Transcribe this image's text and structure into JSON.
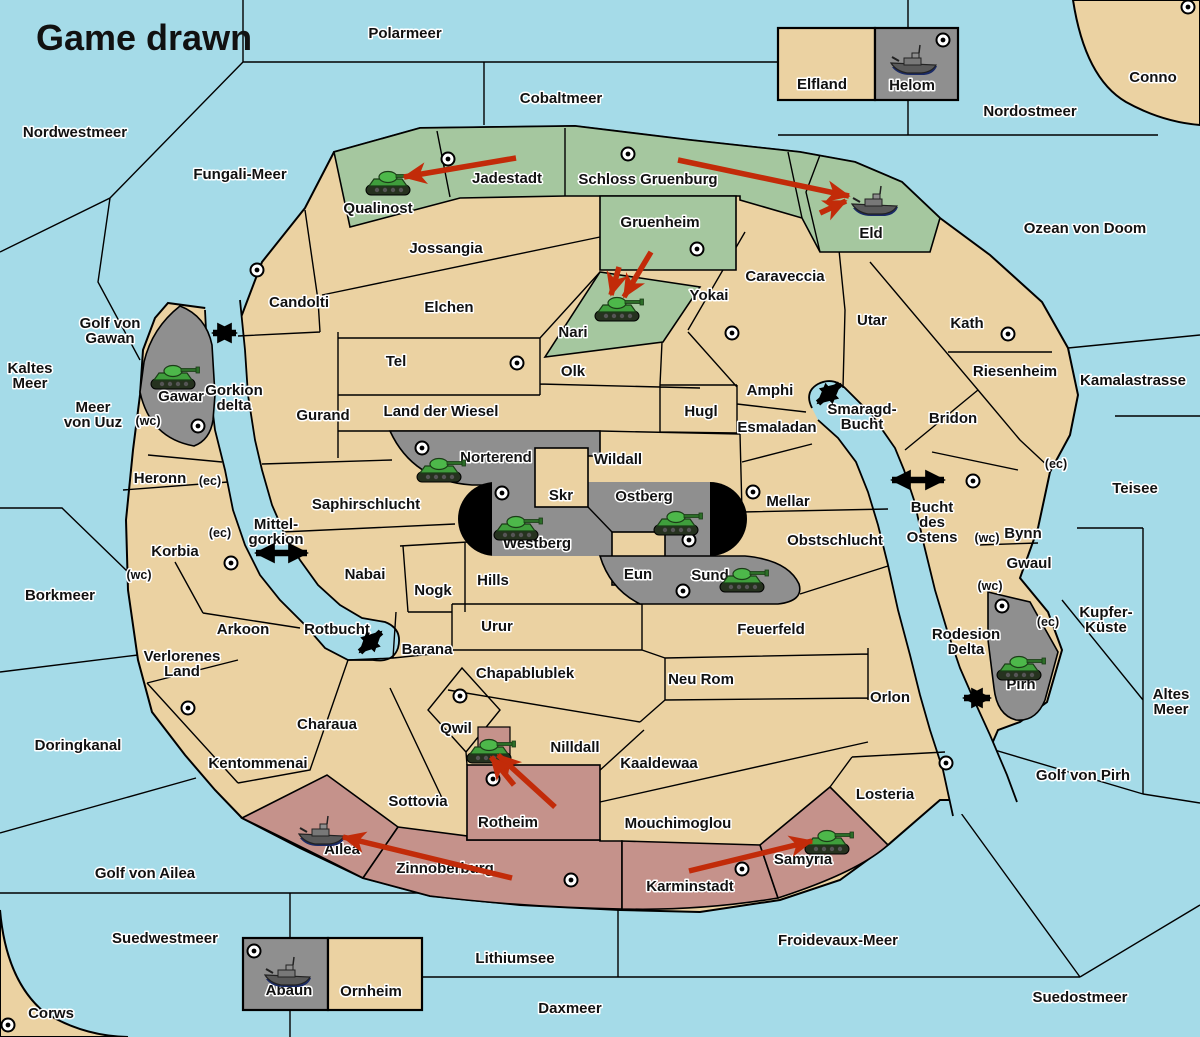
{
  "title": "Game drawn",
  "colors": {
    "water": "#a5dbe8",
    "land": "#ebd2a2",
    "green_power": "#a5c79f",
    "gray_power": "#8f8f8f",
    "red_power": "#c5928b",
    "move_arrow": "#c22b09",
    "link_arrow": "#000000",
    "label": "#111111"
  },
  "labels": {
    "seas": [
      {
        "t": "Polarmeer",
        "x": 405,
        "y": 38
      },
      {
        "t": "Cobaltmeer",
        "x": 561,
        "y": 103
      },
      {
        "t": "Nordostmeer",
        "x": 1030,
        "y": 116
      },
      {
        "t": "Ozean von Doom",
        "x": 1085,
        "y": 233
      },
      {
        "t": "Nordwestmeer",
        "x": 75,
        "y": 137
      },
      {
        "t": "Fungali-Meer",
        "x": 240,
        "y": 179
      },
      {
        "t": "Kaltes Meer",
        "lines": [
          "Kaltes",
          "Meer"
        ],
        "x": 30,
        "y": 373
      },
      {
        "t": "Golf von Gawan",
        "lines": [
          "Golf von",
          "Gawan"
        ],
        "x": 110,
        "y": 328
      },
      {
        "t": "Meer von Uuz",
        "lines": [
          "Meer",
          "von Uuz"
        ],
        "x": 93,
        "y": 412
      },
      {
        "t": "Kamalastrasse",
        "x": 1133,
        "y": 385
      },
      {
        "t": "Teisee",
        "x": 1135,
        "y": 493
      },
      {
        "t": "Kupfer-Küste",
        "lines": [
          "Kupfer-",
          "Küste"
        ],
        "x": 1106,
        "y": 617
      },
      {
        "t": "Borkmeer",
        "x": 60,
        "y": 600
      },
      {
        "t": "Altes Meer",
        "lines": [
          "Altes",
          "Meer"
        ],
        "x": 1171,
        "y": 699
      },
      {
        "t": "Golf von Pirh",
        "x": 1083,
        "y": 780
      },
      {
        "t": "Doringkanal",
        "x": 78,
        "y": 750
      },
      {
        "t": "Golf von Ailea",
        "x": 145,
        "y": 878
      },
      {
        "t": "Suedwestmeer",
        "x": 165,
        "y": 943
      },
      {
        "t": "Froidevaux-Meer",
        "x": 838,
        "y": 945
      },
      {
        "t": "Lithiumsee",
        "x": 515,
        "y": 963
      },
      {
        "t": "Suedostmeer",
        "x": 1080,
        "y": 1002
      },
      {
        "t": "Daxmeer",
        "x": 570,
        "y": 1013
      },
      {
        "t": "Gorkion delta",
        "lines": [
          "Gorkion",
          "delta"
        ],
        "x": 234,
        "y": 395
      },
      {
        "t": "Mittel-gorkion",
        "lines": [
          "Mittel-",
          "gorkion"
        ],
        "x": 276,
        "y": 529
      },
      {
        "t": "Rotbucht",
        "x": 337,
        "y": 634
      },
      {
        "t": "Smaragd-Bucht",
        "lines": [
          "Smaragd-",
          "Bucht"
        ],
        "x": 862,
        "y": 414
      },
      {
        "t": "Bucht des Ostens",
        "lines": [
          "Bucht",
          "des",
          "Ostens"
        ],
        "x": 932,
        "y": 512
      },
      {
        "t": "Rodesion Delta",
        "lines": [
          "Rodesion",
          "Delta"
        ],
        "x": 966,
        "y": 639
      }
    ],
    "regions": [
      {
        "t": "Conno",
        "x": 1153,
        "y": 82
      },
      {
        "t": "Corws",
        "x": 51,
        "y": 1018
      },
      {
        "t": "Qualinost",
        "x": 378,
        "y": 213
      },
      {
        "t": "Jadestadt",
        "x": 507,
        "y": 183
      },
      {
        "t": "Schloss Gruenburg",
        "x": 648,
        "y": 184
      },
      {
        "t": "Gruenheim",
        "x": 660,
        "y": 227
      },
      {
        "t": "Jossangia",
        "x": 446,
        "y": 253
      },
      {
        "t": "Candolti",
        "x": 299,
        "y": 307
      },
      {
        "t": "Elchen",
        "x": 449,
        "y": 312
      },
      {
        "t": "Nari",
        "x": 573,
        "y": 337
      },
      {
        "t": "Yokai",
        "x": 709,
        "y": 300
      },
      {
        "t": "Caraveccia",
        "x": 785,
        "y": 281
      },
      {
        "t": "Eld",
        "x": 871,
        "y": 238
      },
      {
        "t": "Utar",
        "x": 872,
        "y": 325
      },
      {
        "t": "Kath",
        "x": 967,
        "y": 328
      },
      {
        "t": "Riesenheim",
        "x": 1015,
        "y": 376
      },
      {
        "t": "Tel",
        "x": 396,
        "y": 366
      },
      {
        "t": "Olk",
        "x": 573,
        "y": 376
      },
      {
        "t": "Amphi",
        "x": 770,
        "y": 395
      },
      {
        "t": "Gurand",
        "x": 323,
        "y": 420
      },
      {
        "t": "Land der Wiesel",
        "x": 441,
        "y": 416
      },
      {
        "t": "Hugl",
        "x": 701,
        "y": 416
      },
      {
        "t": "Esmaladan",
        "x": 777,
        "y": 432
      },
      {
        "t": "Bridon",
        "x": 953,
        "y": 423
      },
      {
        "t": "Gawar",
        "x": 181,
        "y": 401
      },
      {
        "t": "Norterend",
        "x": 496,
        "y": 462
      },
      {
        "t": "Wildall",
        "x": 618,
        "y": 464
      },
      {
        "t": "Skr",
        "x": 561,
        "y": 500
      },
      {
        "t": "Ostberg",
        "x": 644,
        "y": 501
      },
      {
        "t": "Mellar",
        "x": 788,
        "y": 506
      },
      {
        "t": "Saphirschlucht",
        "x": 366,
        "y": 509
      },
      {
        "t": "Bynn",
        "x": 1023,
        "y": 538
      },
      {
        "t": "Westberg",
        "x": 537,
        "y": 548
      },
      {
        "t": "Obstschlucht",
        "x": 835,
        "y": 545
      },
      {
        "t": "Heronn",
        "x": 160,
        "y": 483
      },
      {
        "t": "Korbia",
        "x": 175,
        "y": 556
      },
      {
        "t": "Gwaul",
        "x": 1029,
        "y": 568
      },
      {
        "t": "Nabai",
        "x": 365,
        "y": 579
      },
      {
        "t": "Eun",
        "x": 638,
        "y": 579
      },
      {
        "t": "Sund",
        "x": 710,
        "y": 580
      },
      {
        "t": "Nogk",
        "x": 433,
        "y": 595
      },
      {
        "t": "Hills",
        "x": 493,
        "y": 585
      },
      {
        "t": "Urur",
        "x": 497,
        "y": 631
      },
      {
        "t": "Feuerfeld",
        "x": 771,
        "y": 634
      },
      {
        "t": "Arkoon",
        "x": 243,
        "y": 634
      },
      {
        "t": "Barana",
        "x": 427,
        "y": 654
      },
      {
        "t": "Verlorenes Land",
        "lines": [
          "Verlorenes",
          "Land"
        ],
        "x": 182,
        "y": 661
      },
      {
        "t": "Chapablublek",
        "x": 525,
        "y": 678
      },
      {
        "t": "Neu Rom",
        "x": 701,
        "y": 684
      },
      {
        "t": "Orlon",
        "x": 890,
        "y": 702
      },
      {
        "t": "Charaua",
        "x": 327,
        "y": 729
      },
      {
        "t": "Qwil",
        "x": 456,
        "y": 733
      },
      {
        "t": "Pirh",
        "x": 1021,
        "y": 689
      },
      {
        "t": "Nilldall",
        "x": 575,
        "y": 752
      },
      {
        "t": "Kaaldewaa",
        "x": 659,
        "y": 768
      },
      {
        "t": "Kentommenai",
        "x": 258,
        "y": 768
      },
      {
        "t": "Sottovia",
        "x": 418,
        "y": 806
      },
      {
        "t": "Rotheim",
        "x": 508,
        "y": 827
      },
      {
        "t": "Losteria",
        "x": 885,
        "y": 799
      },
      {
        "t": "Mouchimoglou",
        "x": 678,
        "y": 828
      },
      {
        "t": "Zinnoberburg",
        "x": 445,
        "y": 873
      },
      {
        "t": "Karminstadt",
        "x": 690,
        "y": 891
      },
      {
        "t": "Samyria",
        "x": 803,
        "y": 864
      },
      {
        "t": "Ailea",
        "x": 342,
        "y": 854
      },
      {
        "t": "Elfland",
        "x": 822,
        "y": 89
      },
      {
        "t": "Helom",
        "x": 912,
        "y": 90
      },
      {
        "t": "Abaun",
        "x": 289,
        "y": 995
      },
      {
        "t": "Ornheim",
        "x": 371,
        "y": 996
      }
    ],
    "coast_marks": [
      {
        "t": "(wc)",
        "x": 148,
        "y": 425
      },
      {
        "t": "(ec)",
        "x": 210,
        "y": 485
      },
      {
        "t": "(ec)",
        "x": 220,
        "y": 537
      },
      {
        "t": "(wc)",
        "x": 139,
        "y": 579
      },
      {
        "t": "(ec)",
        "x": 1056,
        "y": 468
      },
      {
        "t": "(wc)",
        "x": 987,
        "y": 542
      },
      {
        "t": "(wc)",
        "x": 990,
        "y": 590
      },
      {
        "t": "(ec)",
        "x": 1048,
        "y": 626
      }
    ]
  },
  "supply_centers": [
    [
      448,
      159
    ],
    [
      628,
      154
    ],
    [
      943,
      40
    ],
    [
      1188,
      7
    ],
    [
      257,
      270
    ],
    [
      697,
      249
    ],
    [
      732,
      333
    ],
    [
      1008,
      334
    ],
    [
      517,
      363
    ],
    [
      198,
      426
    ],
    [
      422,
      448
    ],
    [
      502,
      493
    ],
    [
      689,
      540
    ],
    [
      753,
      492
    ],
    [
      973,
      481
    ],
    [
      683,
      591
    ],
    [
      231,
      563
    ],
    [
      188,
      708
    ],
    [
      1002,
      606
    ],
    [
      946,
      763
    ],
    [
      460,
      696
    ],
    [
      493,
      779
    ],
    [
      571,
      880
    ],
    [
      742,
      869
    ],
    [
      254,
      951
    ],
    [
      8,
      1025
    ]
  ],
  "units": {
    "armies": [
      {
        "province": "Qualinost",
        "x": 390,
        "y": 181
      },
      {
        "province": "Gawar",
        "x": 175,
        "y": 375
      },
      {
        "province": "Nari",
        "x": 619,
        "y": 307
      },
      {
        "province": "Norterend",
        "x": 441,
        "y": 468
      },
      {
        "province": "Westberg",
        "x": 518,
        "y": 526
      },
      {
        "province": "Ostberg",
        "x": 678,
        "y": 521
      },
      {
        "province": "Sund",
        "x": 744,
        "y": 578
      },
      {
        "province": "Pirh",
        "x": 1021,
        "y": 666
      },
      {
        "province": "Qwil",
        "x": 491,
        "y": 749
      },
      {
        "province": "Samyria",
        "x": 829,
        "y": 840
      }
    ],
    "fleets": [
      {
        "province": "Helom",
        "x": 913,
        "y": 62
      },
      {
        "province": "Eld",
        "x": 874,
        "y": 203
      },
      {
        "province": "Ailea",
        "x": 321,
        "y": 833
      },
      {
        "province": "Abaun",
        "x": 287,
        "y": 974
      }
    ]
  },
  "move_arrows": [
    {
      "x1": 516,
      "y1": 158,
      "x2": 404,
      "y2": 177
    },
    {
      "x1": 678,
      "y1": 160,
      "x2": 849,
      "y2": 196
    },
    {
      "x1": 820,
      "y1": 213,
      "x2": 846,
      "y2": 201
    },
    {
      "x1": 651,
      "y1": 252,
      "x2": 624,
      "y2": 297
    },
    {
      "x1": 619,
      "y1": 267,
      "x2": 611,
      "y2": 295
    },
    {
      "x1": 555,
      "y1": 807,
      "x2": 498,
      "y2": 755
    },
    {
      "x1": 514,
      "y1": 785,
      "x2": 491,
      "y2": 757
    },
    {
      "x1": 512,
      "y1": 878,
      "x2": 343,
      "y2": 837
    },
    {
      "x1": 689,
      "y1": 871,
      "x2": 812,
      "y2": 841
    }
  ],
  "link_arrows": [
    {
      "x1": 213,
      "y1": 333,
      "x2": 236,
      "y2": 333
    },
    {
      "x1": 256,
      "y1": 553,
      "x2": 307,
      "y2": 553
    },
    {
      "x1": 818,
      "y1": 403,
      "x2": 840,
      "y2": 384
    },
    {
      "x1": 892,
      "y1": 480,
      "x2": 944,
      "y2": 480
    },
    {
      "x1": 964,
      "y1": 698,
      "x2": 990,
      "y2": 698
    },
    {
      "x1": 360,
      "y1": 652,
      "x2": 381,
      "y2": 632
    }
  ]
}
